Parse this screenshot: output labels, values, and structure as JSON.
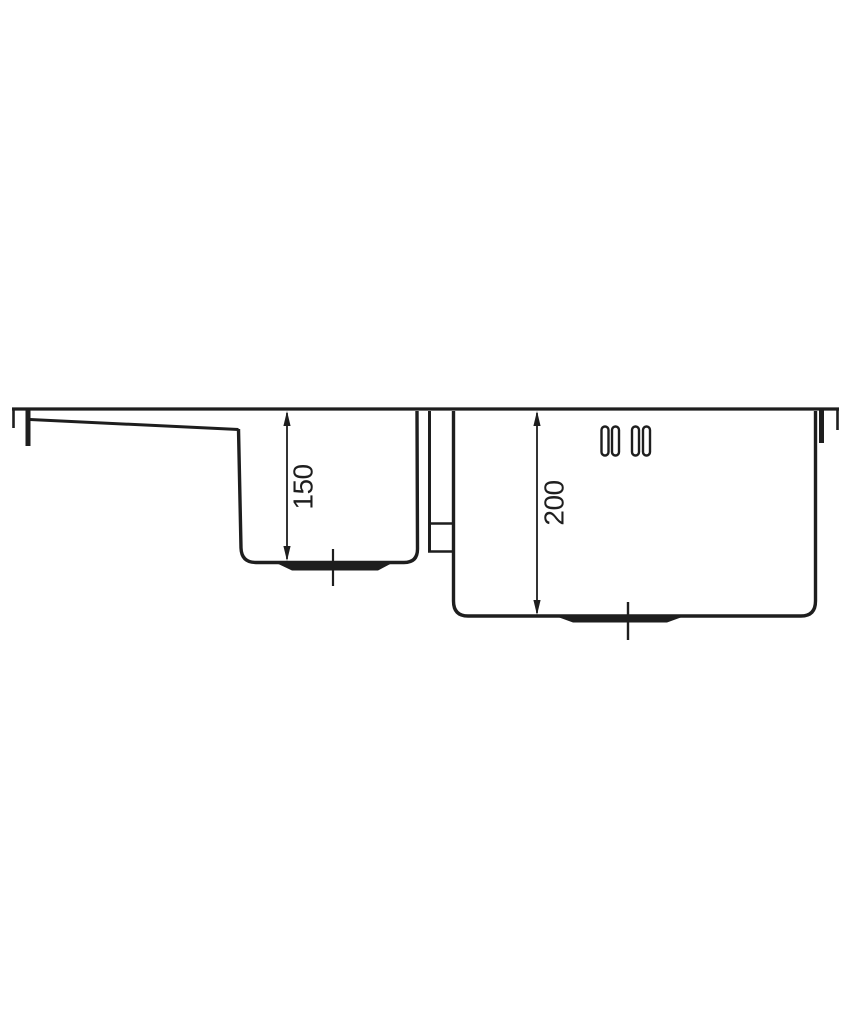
{
  "page": {
    "background_color": "#ffffff",
    "line_color": "#1e1e1e",
    "drawing_type": "sink-cross-section"
  },
  "drawing": {
    "dimensions": {
      "left_bowl_depth": {
        "value": "150",
        "orientation": "vertical-rotated"
      },
      "right_bowl_depth": {
        "value": "200",
        "orientation": "vertical-rotated"
      }
    },
    "tap_holes": {
      "slot_count": 4
    },
    "drain_marks": {
      "count": 2
    }
  }
}
